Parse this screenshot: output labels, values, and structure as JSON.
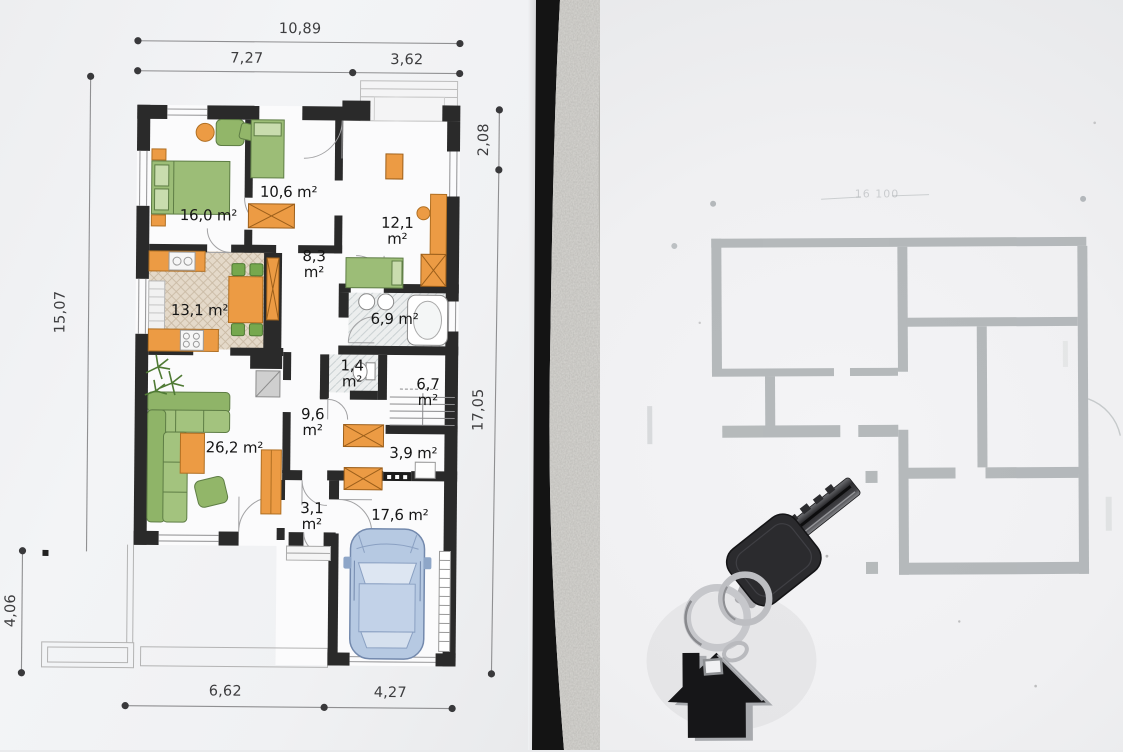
{
  "left_plan": {
    "dimensions": {
      "top_total": "10,89",
      "top_left": "7,27",
      "top_right": "3,62",
      "right_upper": "2,08",
      "right_lower": "17,05",
      "left_upper": "15,07",
      "left_lower": "4,06",
      "bottom_left": "6,62",
      "bottom_right": "4,27"
    },
    "rooms": [
      {
        "name": "bedroom-main",
        "label": "16,0 m²"
      },
      {
        "name": "bedroom-2",
        "label": "10,6 m²"
      },
      {
        "name": "bedroom-3",
        "label": "12,1\nm²"
      },
      {
        "name": "hallway-upper",
        "label": "8,3\nm²"
      },
      {
        "name": "kitchen",
        "label": "13,1 m²"
      },
      {
        "name": "bathroom",
        "label": "6,9 m²"
      },
      {
        "name": "wc",
        "label": "1,4\nm²"
      },
      {
        "name": "stairs",
        "label": "6,7\nm²"
      },
      {
        "name": "hallway-lower",
        "label": "9,6\nm²"
      },
      {
        "name": "living-room",
        "label": "26,2 m²"
      },
      {
        "name": "storage",
        "label": "3,9 m²"
      },
      {
        "name": "entry",
        "label": "3,1\nm²"
      },
      {
        "name": "garage",
        "label": "17,6 m²"
      }
    ]
  },
  "right_plan": {
    "top_dimension": "16 100"
  },
  "objects": {
    "key": "car-key",
    "keychain": "house-keychain"
  },
  "colors": {
    "wall_black": "#2a2a2a",
    "furniture_orange": "#ec9b44",
    "furniture_green": "#92b669",
    "car_blue": "#b6c9e2",
    "faint_plan_gray": "#a6abad",
    "concrete_gray": "#d7d6d2",
    "paper_white": "#f1f2f4"
  }
}
